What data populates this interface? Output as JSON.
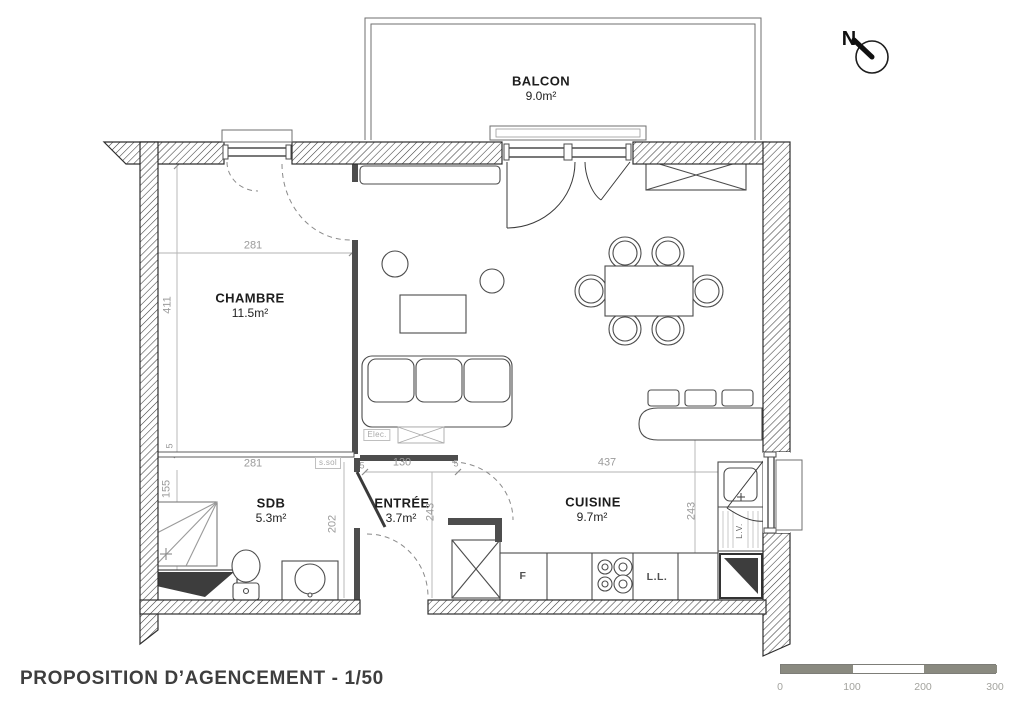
{
  "header": {
    "compass_label": "N"
  },
  "rooms": {
    "balcon": {
      "name": "BALCON",
      "area": "9.0m²"
    },
    "chambre": {
      "name": "CHAMBRE",
      "area": "11.5m²"
    },
    "sdb": {
      "name": "SDB",
      "area": "5.3m²"
    },
    "entree": {
      "name": "ENTRÉE",
      "area": "3.7m²"
    },
    "cuisine": {
      "name": "CUISINE",
      "area": "9.7m²"
    }
  },
  "dimensions": {
    "chambre_width": "281",
    "chambre_height": "411",
    "sdb_width": "281",
    "sdb_height": "155",
    "sdb_wall": "202",
    "wall_thickness_1": "5",
    "wall_thickness_2": "5",
    "wall_thickness_3": "5",
    "entree_width": "130",
    "entree_height": "243",
    "cuisine_width": "437",
    "cuisine_height": "243"
  },
  "annotations": {
    "electrical": "Elec.",
    "floor_box": "s.sol",
    "fridge": "F",
    "washing_machine": "L.L.",
    "dishwasher": "L.V."
  },
  "scale_bar": {
    "ticks": [
      "0",
      "100",
      "200",
      "300"
    ]
  },
  "footer": {
    "title": "PROPOSITION D’AGENCEMENT - 1/50"
  }
}
